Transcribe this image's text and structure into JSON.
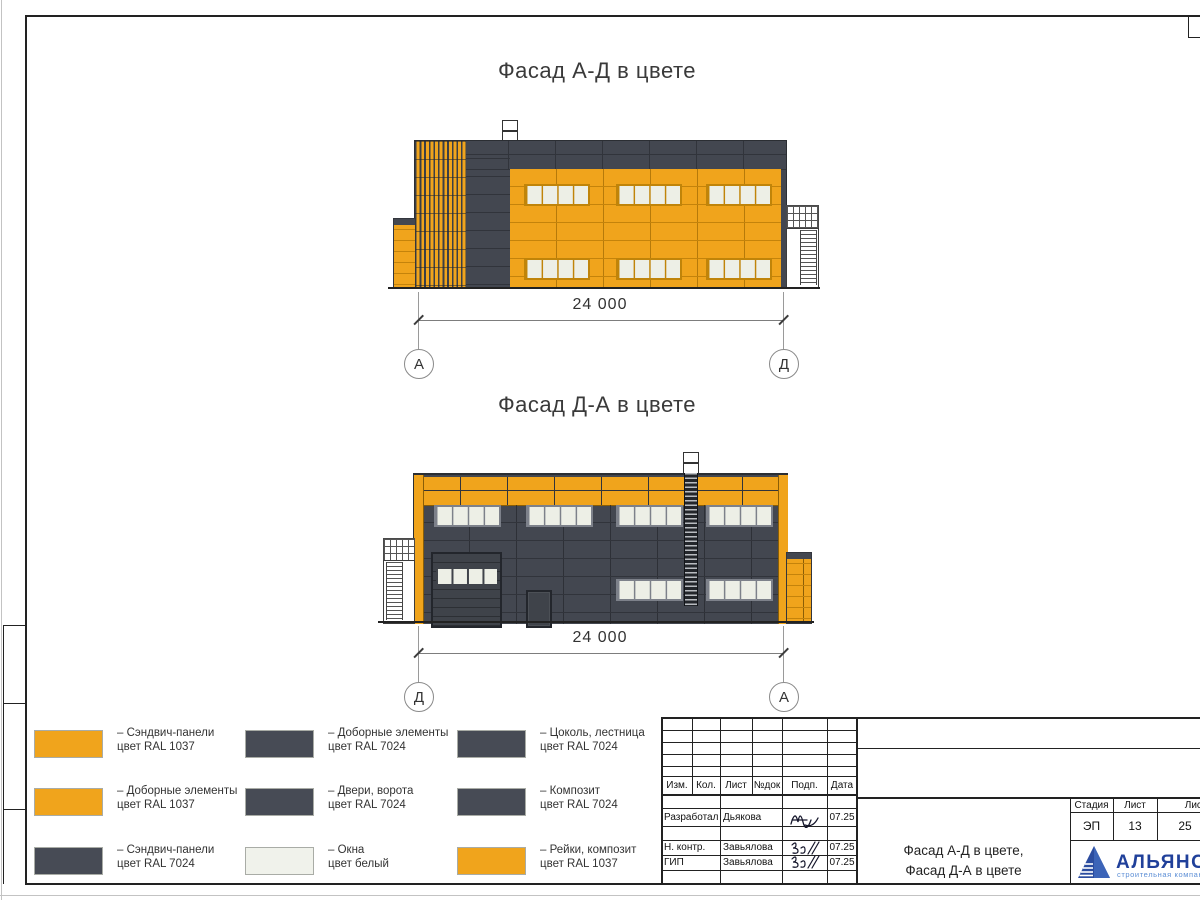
{
  "sheet": {
    "kind": "Архитектурный чертёж — фасады в цвете"
  },
  "facades": [
    {
      "title": "Фасад А-Д в цвете",
      "dimension": "24 000",
      "axis_left": "А",
      "axis_right": "Д"
    },
    {
      "title": "Фасад Д-А в цвете",
      "dimension": "24 000",
      "axis_left": "Д",
      "axis_right": "А"
    }
  ],
  "colors": {
    "ral_1037_orange": "#F0A41C",
    "ral_7024_grey": "#434750",
    "window_white": "#EDEFE6",
    "logo_blue": "#20409A",
    "logo_light_blue": "#5D8FD6"
  },
  "legend": {
    "items": [
      {
        "color": "#F0A41C",
        "line1": "– Сэндвич-панели",
        "line2": "цвет RAL 1037"
      },
      {
        "color": "#F0A41C",
        "line1": "– Доборные элементы",
        "line2": "цвет RAL 1037"
      },
      {
        "color": "#474B55",
        "line1": "– Сэндвич-панели",
        "line2": "цвет RAL 7024"
      },
      {
        "color": "#474B55",
        "line1": "– Доборные элементы",
        "line2": "цвет RAL 7024"
      },
      {
        "color": "#474B55",
        "line1": "– Двери, ворота",
        "line2": "цвет RAL 7024"
      },
      {
        "color": "#F0F2EB",
        "line1": "– Окна",
        "line2": "цвет белый"
      },
      {
        "color": "#474B55",
        "line1": "– Цоколь, лестница",
        "line2": "цвет RAL 7024"
      },
      {
        "color": "#474B55",
        "line1": "– Композит",
        "line2": "цвет RAL 7024"
      },
      {
        "color": "#F0A41C",
        "line1": "– Рейки, композит",
        "line2": "цвет RAL 1037"
      }
    ]
  },
  "titleblock": {
    "revision_headers": [
      "Изм.",
      "Кол.",
      "Лист",
      "№док",
      "Подп.",
      "Дата"
    ],
    "signoff_rows": [
      {
        "role": "Разработал",
        "name": "Дьякова",
        "date": "07.25"
      },
      {
        "role": "Н. контр.",
        "name": "Завьялова",
        "date": "07.25"
      },
      {
        "role": "ГИП",
        "name": "Завьялова",
        "date": "07.25"
      }
    ],
    "stage_label": "Стадия",
    "sheet_label": "Лист",
    "sheets_label": "Листов",
    "stage": "ЭП",
    "sheet": "13",
    "sheets": "25",
    "title_line1": "Фасад А-Д в цвете,",
    "title_line2": "Фасад Д-А в цвете",
    "company": {
      "name": "АЛЬЯНС",
      "tagline": "строительная компания"
    }
  }
}
